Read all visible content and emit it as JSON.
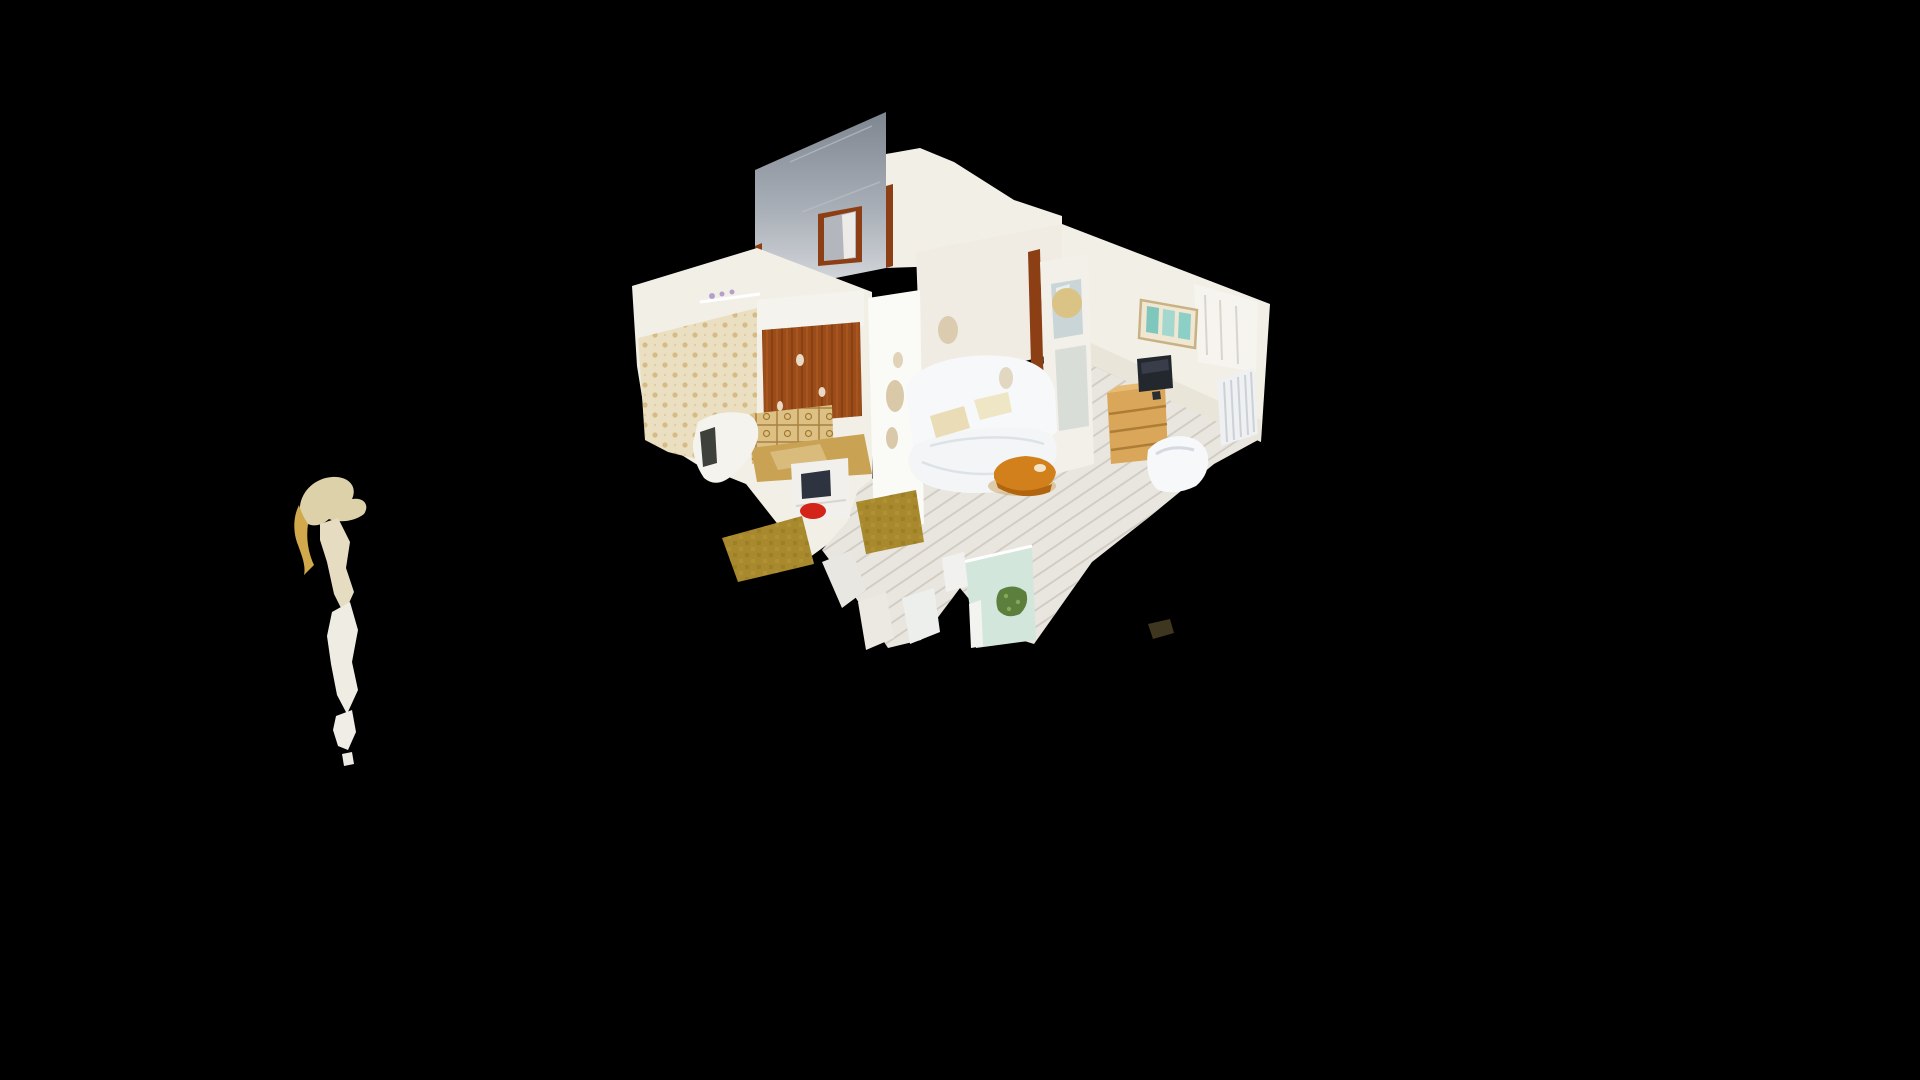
{
  "viewer": {
    "app": "3d-dollhouse-scan-viewer",
    "mode": "dollhouse-view",
    "background": "#000000",
    "scene_description": "Cut-away 3D photogrammetry dollhouse of a studio apartment (kitchen, living room, entry hall) floating on a black void, viewed from above at an oblique angle, with a stray detached scan fragment floating at lower left",
    "visible_objects": [
      "tall gray hallway wall",
      "entry doorway with brown frame",
      "kitchen wallpaper wall",
      "wood kitchen cabinet",
      "tiled backsplash",
      "kitchen counter with sink",
      "white lower cabinet with oven",
      "red object on shelf",
      "bathtub",
      "olive vinyl floor mats",
      "white plank floor",
      "white partition wall",
      "sofa bed with cream pillows",
      "round wooden coffee table",
      "mirrored white door",
      "framed teal triptych artwork",
      "television on dresser",
      "pine dresser",
      "white armchair",
      "radiator",
      "window with curtains",
      "mint side table with plant",
      "white chair fragments",
      "dark floor shard",
      "stray scan fragment"
    ]
  },
  "colors": {
    "background": "#000000",
    "gray_wall_top": "#838a95",
    "gray_wall_bottom": "#d9dbdf",
    "wall_white": "#f2efe7",
    "wall_bright": "#fafaf6",
    "wall_shaded": "#f0ece3",
    "baseboard_shadow": "#e2dccd",
    "wallpaper": "#ebdfc1",
    "hood_white": "#f5f3ed",
    "shelf_items": "#b5a0cc",
    "wood_cabinet": "#9a4c1b",
    "scan_hole": "#f2ead8",
    "tile": "#dcc084",
    "counter": "#c9a254",
    "counter_light": "#dcc084",
    "cabinet_white": "#f1f0ec",
    "oven_dark": "#2d3440",
    "red_object": "#d42318",
    "bath_white": "#f4f3ee",
    "dark_opening": "#3e403c",
    "lino": "#a8892e",
    "floor": "#e9e6df",
    "door_frame_brown": "#8c3e14",
    "doorway_interior": "#b3b7bd",
    "door_leaf": "#ecebe7",
    "door_white": "#f3f0e9",
    "mirror_glass": "#c9d5d7",
    "mirror_streak": "#eef2f2",
    "mirror_glass2": "#d8ded7",
    "tan_blob": "#dbc386",
    "frame_bg": "#efe7d1",
    "art_teal_1": "#7fc7bd",
    "art_teal_2": "#a4d8cf",
    "art_teal_3": "#8ccfc6",
    "dresser": "#d9a65a",
    "dresser_top": "#e7bc72",
    "tv": "#23272e",
    "tv_glare": "#3d4450",
    "tv_stand": "#2a2e34",
    "radiator": "#eef0f2",
    "curtain_panel": "#f6f4ee",
    "sofa": "#f7f8f9",
    "mattress": "#f3f5f7",
    "pillow": "#e9dcb6",
    "pillow2": "#efe6c6",
    "patch_beige": "#d9c9a8",
    "coffee_table": "#d2801c",
    "coffee_table_dark": "#b2650f",
    "coffee_speckle": "#f3e3c8",
    "table_shadow": "#caa25e",
    "mint_table": "#d3e6dc",
    "plant": "#5d7f3e",
    "plant_light": "#86a855",
    "leg_white": "#f3f3ef",
    "chair_frag": "#edefed",
    "chair_frag2": "#f1f2f0",
    "floor_frag": "#e9e7e1",
    "floor_frag2": "#ece9e2",
    "shard_dark": "#4a4026",
    "fragment_beige": "#ddd1a9",
    "fragment_gold": "#d2a84c",
    "fragment_cream": "#e6dcc2",
    "fragment_white": "#efece3",
    "fragment_piece": "#f0ede6",
    "fragment_tip": "#eceae2"
  }
}
